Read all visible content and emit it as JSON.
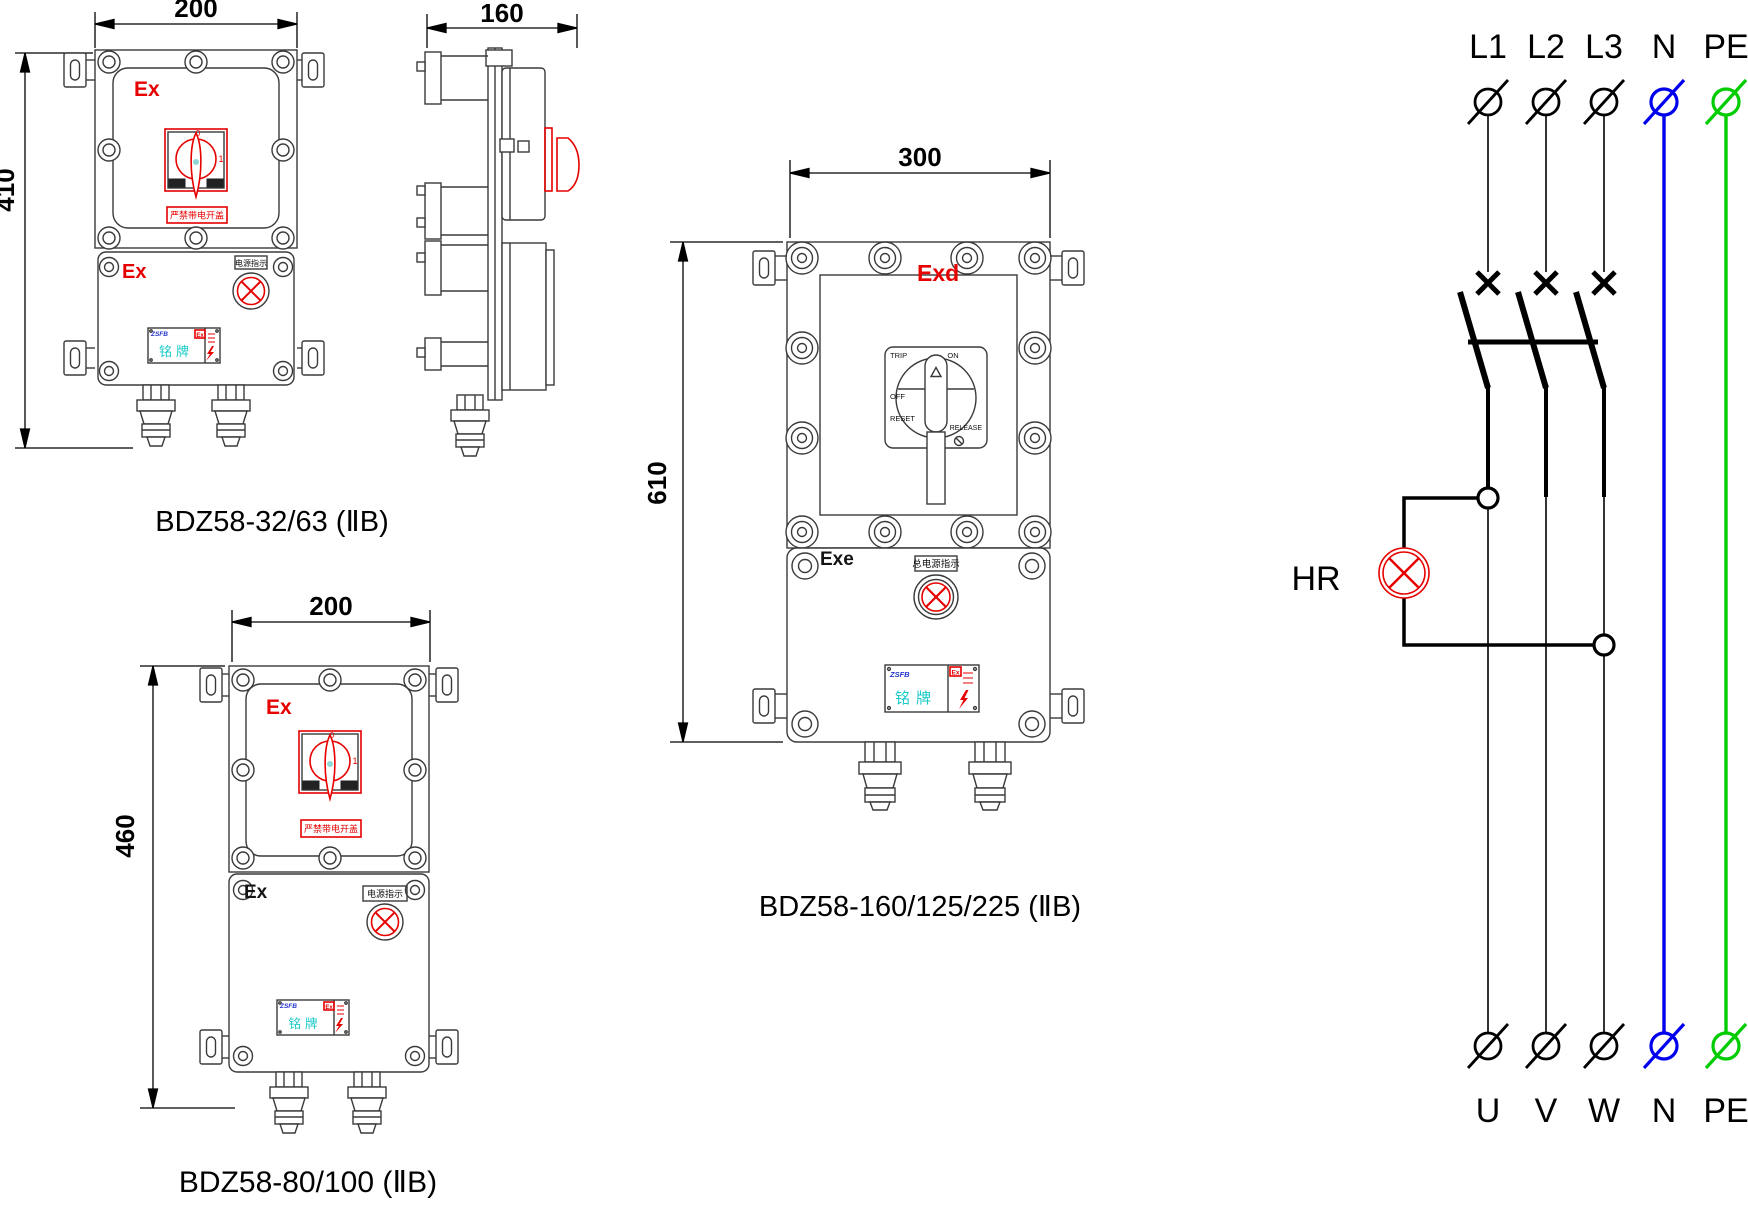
{
  "box1": {
    "width_dim": "200",
    "height_dim": "410",
    "ex_cover": "Ex",
    "ex_base": "Ex",
    "switch_pos_off": "0",
    "switch_pos_on": "1",
    "warning_label": "严禁带电开盖",
    "indicator_label": "电源指示",
    "nameplate_brand": "ZSFB",
    "nameplate_title": "铭牌",
    "nameplate_ex": "Ex",
    "caption": "BDZ58-32/63  (ⅡB)"
  },
  "side_view": {
    "width_dim": "160"
  },
  "box2": {
    "width_dim": "300",
    "height_dim": "610",
    "ex_cover": "Exd",
    "ex_base": "Exe",
    "switch_trip": "TRIP",
    "switch_on": "ON",
    "switch_off": "OFF",
    "switch_reset": "RESET",
    "switch_release": "RELEASE",
    "indicator_label": "总电源指示",
    "nameplate_brand": "ZSFB",
    "nameplate_title": "铭牌",
    "nameplate_ex": "Ex",
    "caption": "BDZ58-160/125/225  (ⅡB)"
  },
  "box3": {
    "width_dim": "200",
    "height_dim": "460",
    "ex_cover": "Ex",
    "ex_base": "Ex",
    "switch_pos_off": "0",
    "switch_pos_on": "1",
    "warning_label": "严禁带电开盖",
    "indicator_label": "电源指示",
    "nameplate_brand": "ZSFB",
    "nameplate_title": "铭牌",
    "nameplate_ex": "Ex",
    "caption": "BDZ58-80/100  (ⅡB)"
  },
  "circuit": {
    "top_labels": [
      "L1",
      "L2",
      "L3",
      "N",
      "PE"
    ],
    "bottom_labels": [
      "U",
      "V",
      "W",
      "N",
      "PE"
    ],
    "lamp_label": "HR"
  },
  "colors": {
    "red": "#e60000",
    "neutral_blue": "#0000ee",
    "earth_green": "#00cc00",
    "nameplate_cyan": "#17c9c9",
    "brand_blue": "#2233cc"
  }
}
